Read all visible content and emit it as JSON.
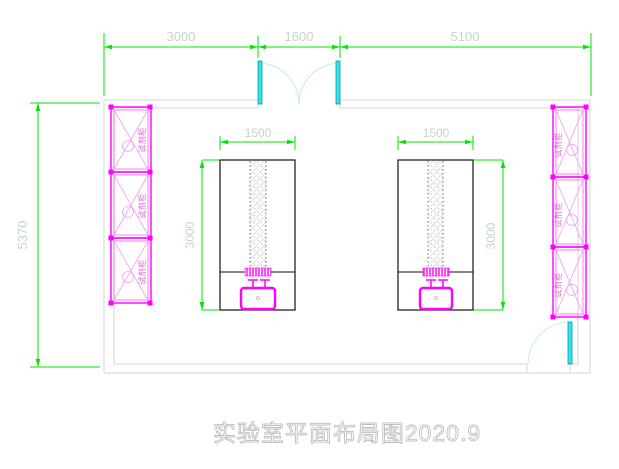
{
  "drawing": {
    "title": "实验室平面布局图2020.9",
    "type_note": "laboratory floor plan"
  },
  "dimensions": {
    "top_left": "3000",
    "top_middle": "1600",
    "top_right": "5100",
    "wall_left": "5370",
    "bench_left_width": "1500",
    "bench_left_depth": "3000",
    "bench_right_width": "1500",
    "bench_right_depth": "3000"
  },
  "labels": {
    "reagent_cabinet": "试剂柜"
  },
  "colors": {
    "dimension_green": "#00e600",
    "dimension_text": "#c3d6c3",
    "cabinet_magenta": "#ff00ff",
    "cabinet_hatch_pink": "#f39bf3",
    "door_cyan": "#2ee3ea",
    "door_arc": "#bfecec",
    "wall_gray": "#d6d6d6",
    "bench_outline": "#111111",
    "title_gray": "#bfbfbf"
  }
}
